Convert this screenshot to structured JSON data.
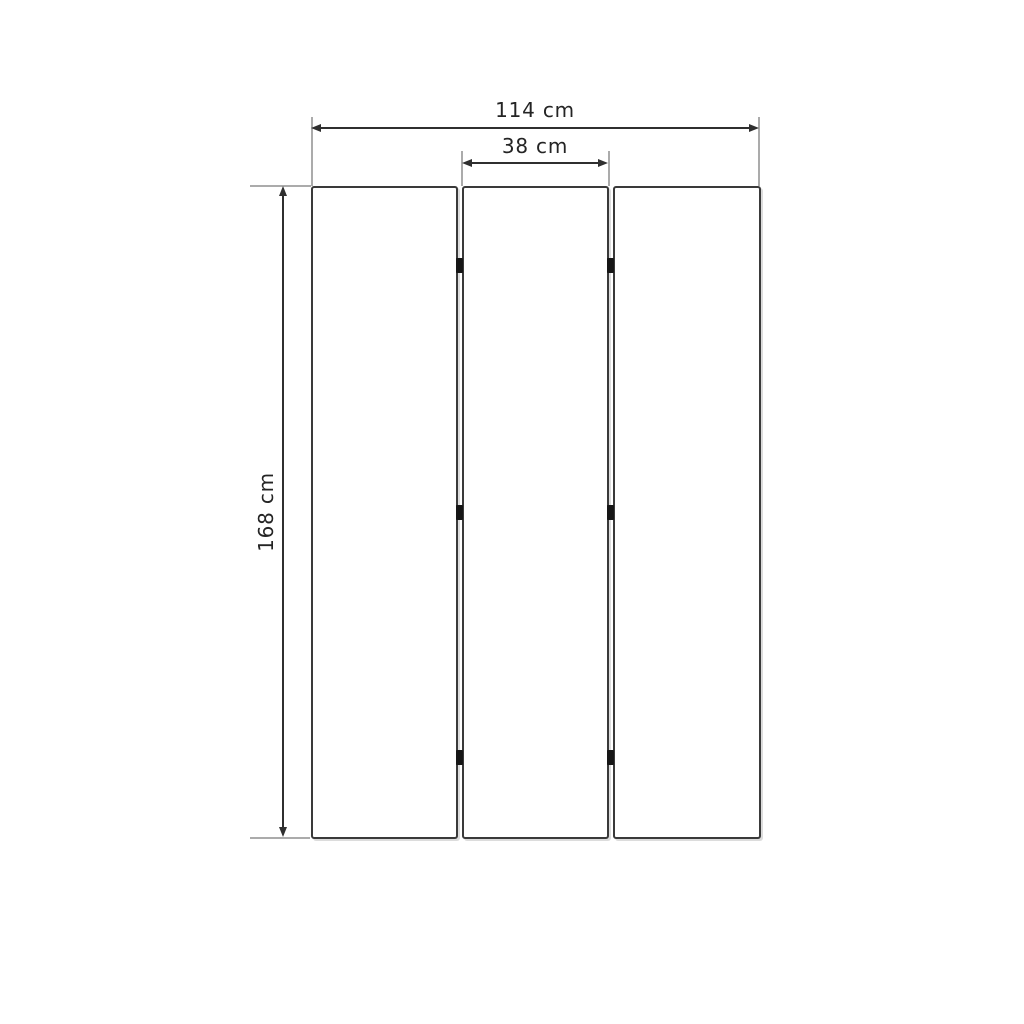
{
  "diagram": {
    "type": "technical-drawing",
    "subject": "three-panel folding screen, front elevation with dimensions",
    "panel_count": 3,
    "hinge_rows": 3,
    "labels": {
      "total_width": "114 cm",
      "panel_width": "38 cm",
      "height": "168 cm"
    },
    "colors": {
      "outline": "#3a3a3a",
      "dimension_line": "#2f2f2f",
      "extension_line": "#ababab",
      "hinge": "#161616",
      "text": "#242424",
      "background": "#ffffff"
    }
  }
}
